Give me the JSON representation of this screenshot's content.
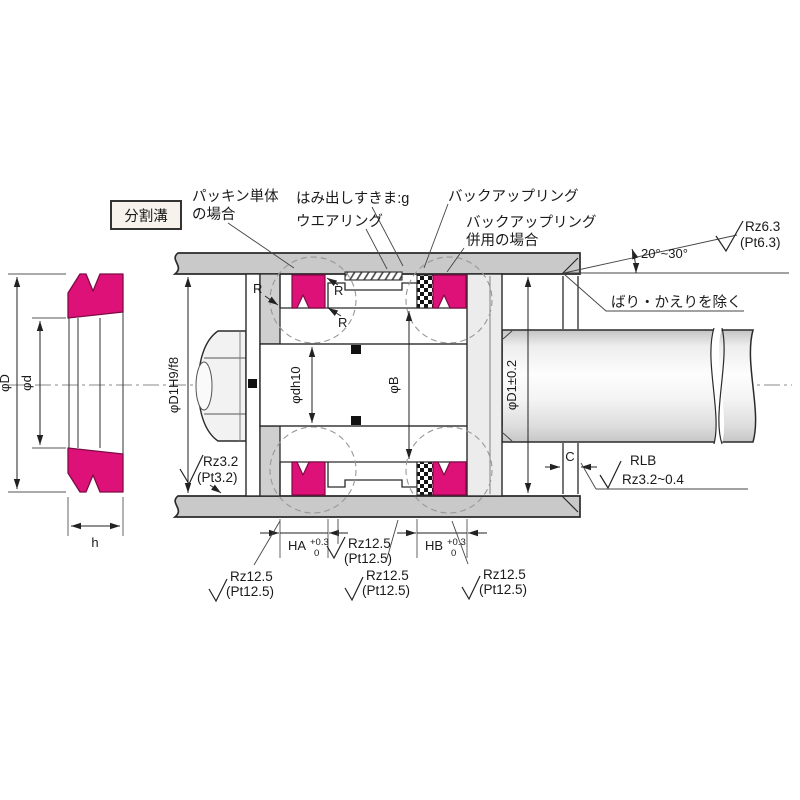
{
  "box": {
    "label": "分割溝"
  },
  "callouts": {
    "packing_line1": "パッキン単体",
    "packing_line2": "の場合",
    "extrusion_gap": "はみ出しすきま:g",
    "wear_ring": "ウエアリング",
    "backup_ring": "バックアップリング",
    "backup_ring2_line1": "バックアップリング",
    "backup_ring2_line2": "併用の場合",
    "deburr": "ばり・かえりを除く",
    "chamfer_angle": "20°~30°",
    "rlb": "RLB",
    "rlb_roughness": "Rz3.2~0.4"
  },
  "finish": {
    "rz63": "Rz6.3",
    "pt63": "(Pt6.3)",
    "rz32": "Rz3.2",
    "pt32": "(Pt3.2)",
    "rz125": "Rz12.5",
    "pt125": "(Pt12.5)"
  },
  "dims": {
    "outer_dia": "φD",
    "inner_dia": "φd",
    "width": "h",
    "bore_fit": "φD1H9/f8",
    "groove_dia": "φdh10",
    "land_dia": "φB",
    "bore_tol": "φD1±0.2",
    "clearance": "C",
    "ha": "HA",
    "ha_tol_upper": "+0.3",
    "ha_tol_lower": "0",
    "hb": "HB",
    "hb_tol_upper": "+0.3",
    "hb_tol_lower": "0",
    "radius": "R"
  },
  "colors": {
    "seal": "#de1179",
    "seal_stroke": "#7e0a45",
    "wall": "#c9c9c9",
    "split_label": "#8b3a2e"
  }
}
